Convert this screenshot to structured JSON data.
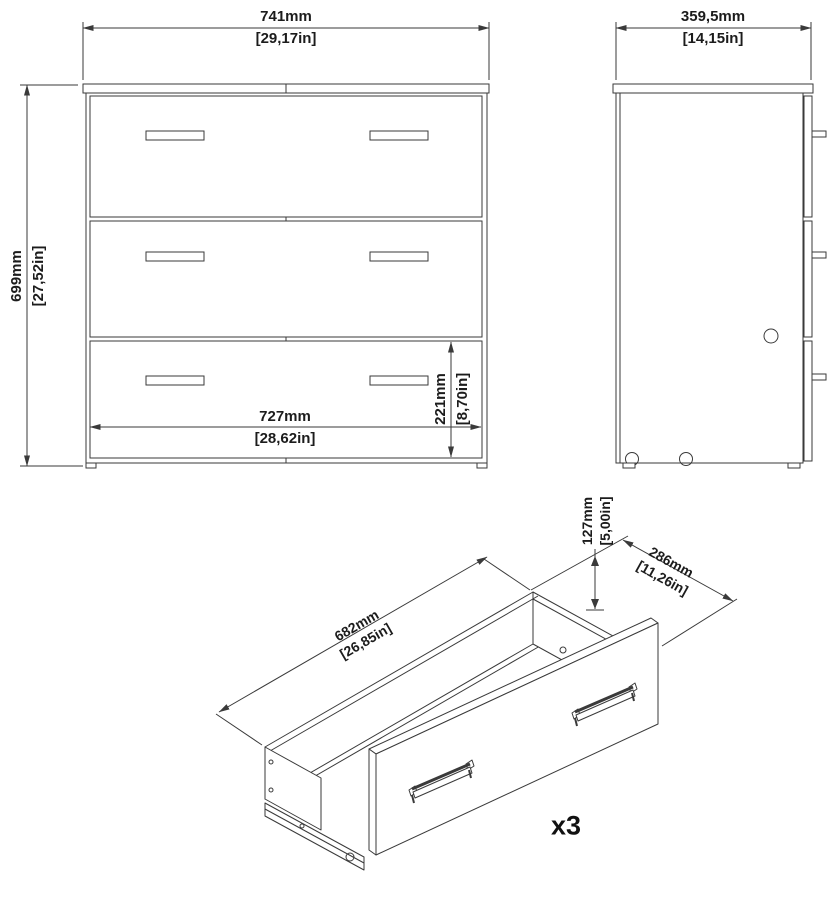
{
  "front_view": {
    "width": {
      "mm": "741mm",
      "inch": "[29,17in]"
    },
    "height": {
      "mm": "699mm",
      "inch": "[27,52in]"
    },
    "inner_width": {
      "mm": "727mm",
      "inch": "[28,62in]"
    },
    "bottom_drawer_height": {
      "mm": "221mm",
      "inch": "[8,70in]"
    }
  },
  "side_view": {
    "depth": {
      "mm": "359,5mm",
      "inch": "[14,15in]"
    }
  },
  "drawer_view": {
    "width": {
      "mm": "682mm",
      "inch": "[26,85in]"
    },
    "depth": {
      "mm": "286mm",
      "inch": "[11,26in]"
    },
    "height": {
      "mm": "127mm",
      "inch": "[5,00in]"
    },
    "quantity": "x3"
  },
  "colors": {
    "line": "#3a3a3a",
    "text": "#1c1c1c",
    "background": "#ffffff"
  }
}
